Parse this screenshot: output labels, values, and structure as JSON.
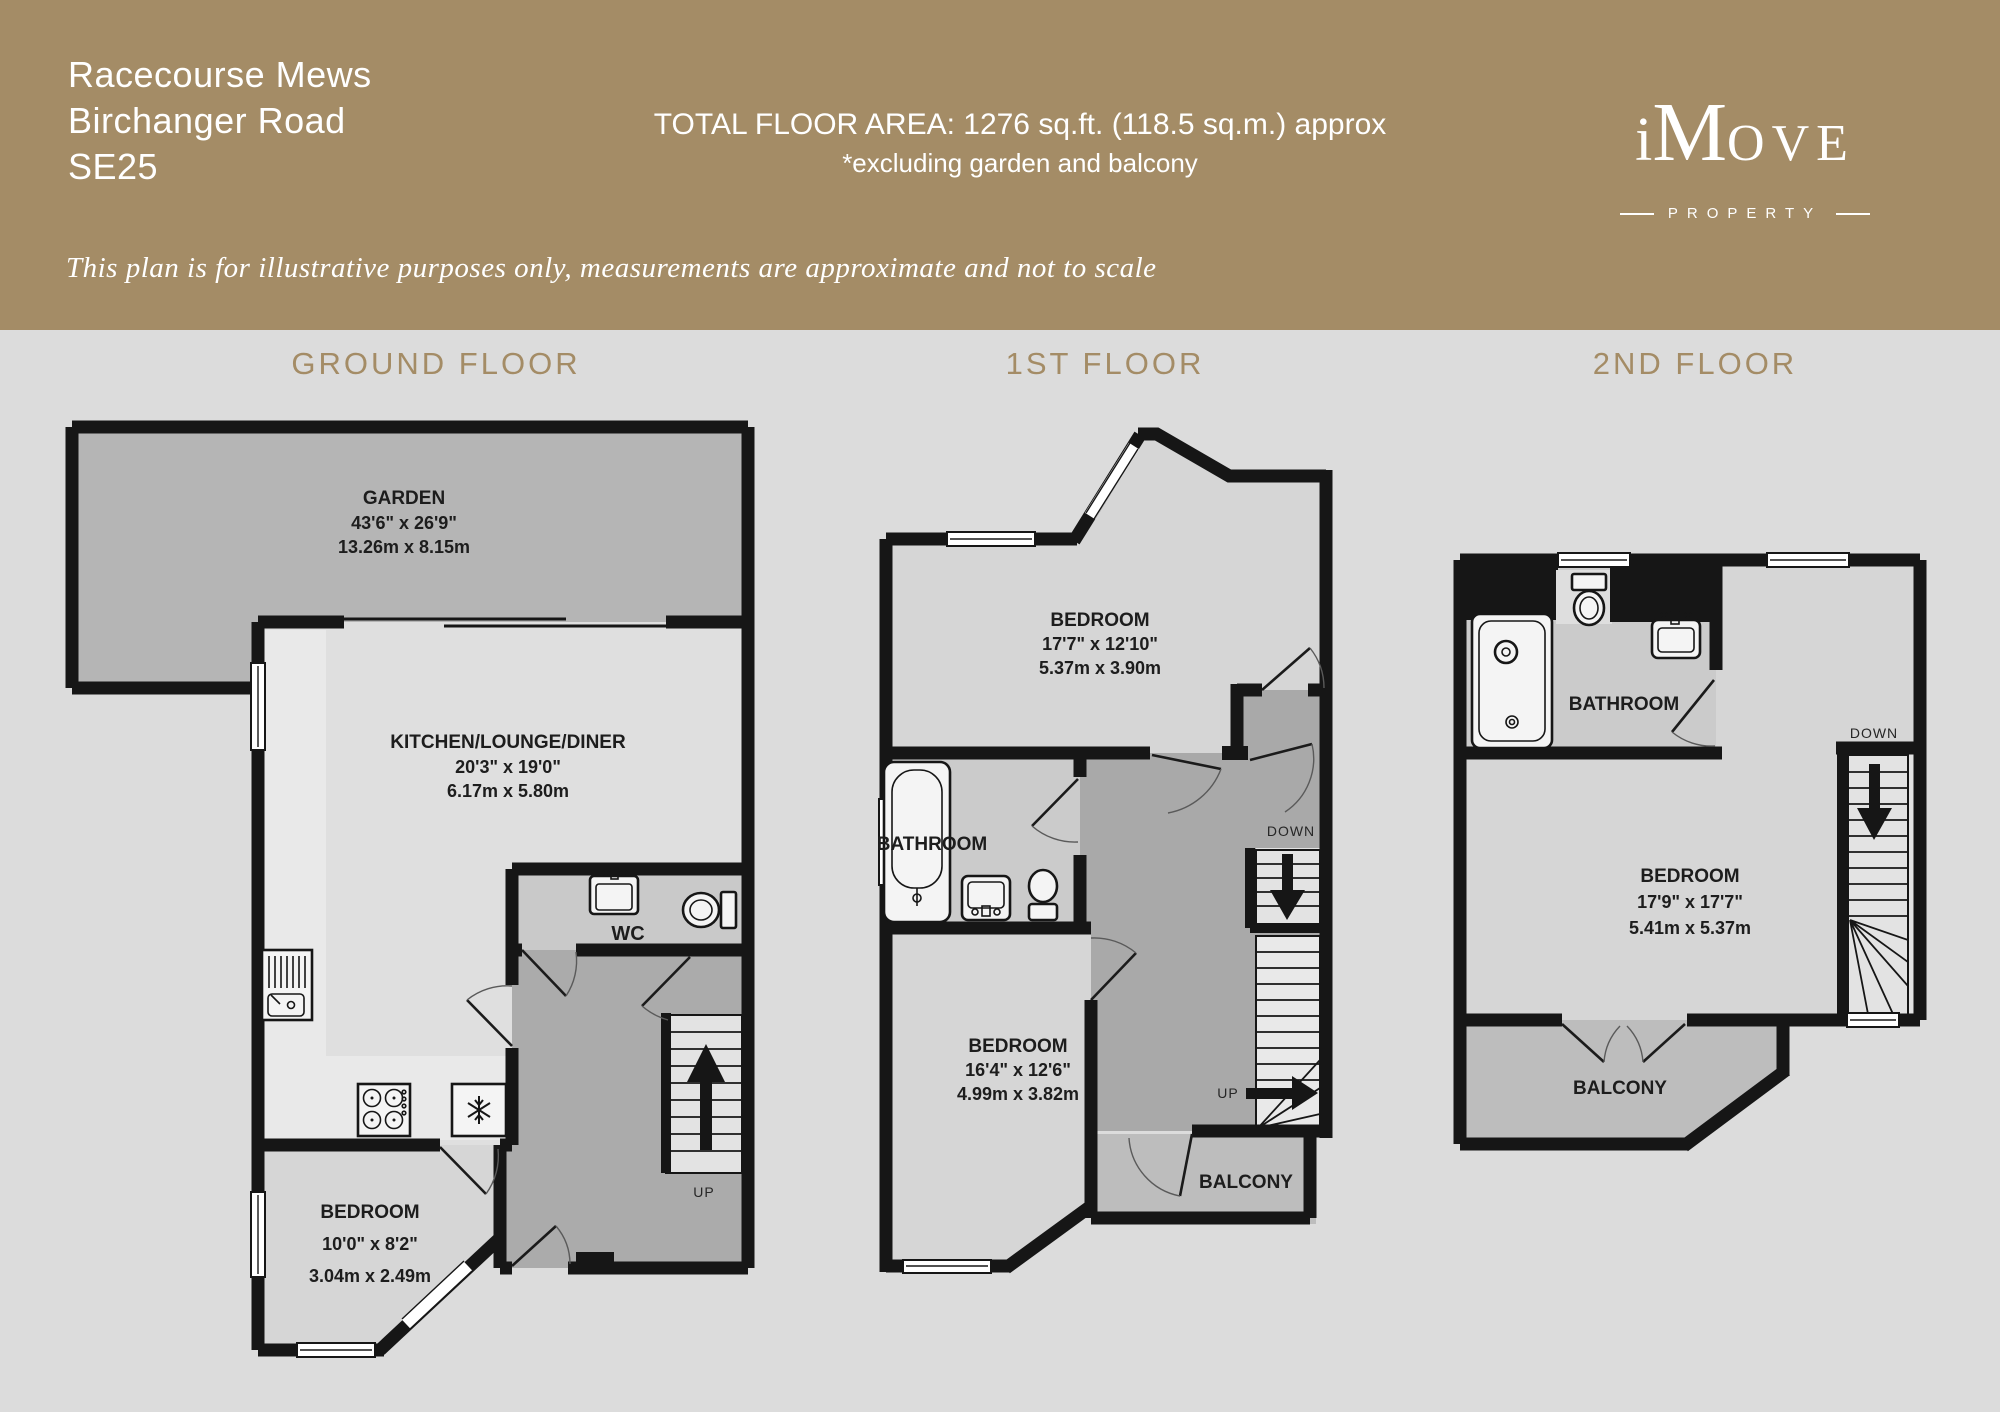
{
  "colors": {
    "header_bg": "#a48c66",
    "page_bg": "#dcdcdc",
    "wall": "#161616",
    "accent_text": "#a48c66",
    "garden_fill": "#b5b5b5",
    "room_fill": "#d6d6d6",
    "hall_fill": "#a9a9a9",
    "balcony_fill": "#bdbdbd"
  },
  "header": {
    "address_lines": [
      "Racecourse Mews",
      "Birchanger Road",
      "SE25"
    ],
    "total_area": "TOTAL FLOOR AREA: 1276 sq.ft. (118.5 sq.m.) approx",
    "area_note": "*excluding garden and balcony",
    "disclaimer": "This plan is for illustrative purposes only, measurements are approximate and not to scale",
    "logo": {
      "part_i": "i",
      "part_m": "M",
      "part_rest": "OVE",
      "subtitle": "PROPERTY"
    }
  },
  "floors": {
    "ground": {
      "label": "GROUND FLOOR",
      "garden": {
        "name": "GARDEN",
        "dims_ft": "43'6\" x 26'9\"",
        "dims_m": "13.26m x 8.15m"
      },
      "kitchen": {
        "name": "KITCHEN/LOUNGE/DINER",
        "dims_ft": "20'3\" x 19'0\"",
        "dims_m": "6.17m x 5.80m"
      },
      "wc": {
        "name": "WC"
      },
      "bedroom": {
        "name": "BEDROOM",
        "dims_ft": "10'0\" x 8'2\"",
        "dims_m": "3.04m x 2.49m"
      },
      "up": "UP"
    },
    "first": {
      "label": "1ST FLOOR",
      "bedroom_front": {
        "name": "BEDROOM",
        "dims_ft": "17'7\" x 12'10\"",
        "dims_m": "5.37m x 3.90m"
      },
      "bathroom": {
        "name": "BATHROOM"
      },
      "bedroom_back": {
        "name": "BEDROOM",
        "dims_ft": "16'4\" x 12'6\"",
        "dims_m": "4.99m x 3.82m"
      },
      "balcony": {
        "name": "BALCONY"
      },
      "down": "DOWN",
      "up": "UP"
    },
    "second": {
      "label": "2ND FLOOR",
      "bathroom": {
        "name": "BATHROOM"
      },
      "bedroom": {
        "name": "BEDROOM",
        "dims_ft": "17'9\" x 17'7\"",
        "dims_m": "5.41m x 5.37m"
      },
      "balcony": {
        "name": "BALCONY"
      },
      "down": "DOWN"
    }
  }
}
